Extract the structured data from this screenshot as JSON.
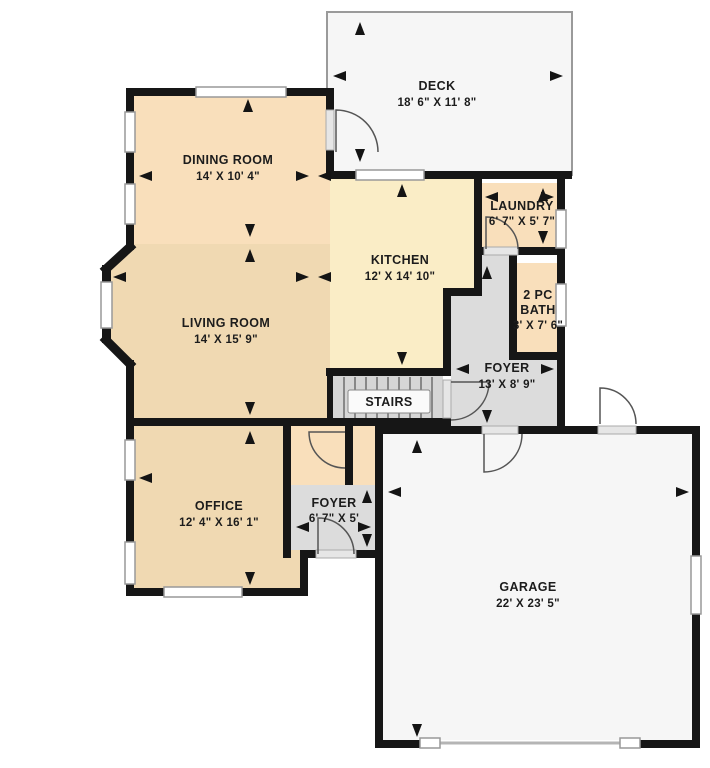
{
  "colors": {
    "wall": "#161616",
    "room_tan": "#f0d9b2",
    "room_peach": "#f9dfbb",
    "room_cream": "#faedc6",
    "room_gray": "#dcdcdc",
    "room_stairs": "#d6d6d6",
    "room_white": "#f6f6f6"
  },
  "rooms": {
    "deck": {
      "name": "DECK",
      "dims": "18' 6\" X 11' 8\""
    },
    "dining": {
      "name": "DINING ROOM",
      "dims": "14' X 10' 4\""
    },
    "kitchen": {
      "name": "KITCHEN",
      "dims": "12' X 14' 10\""
    },
    "laundry": {
      "name": "LAUNDRY",
      "dims": "6' 7\" X 5' 7\""
    },
    "bath": {
      "name_line1": "2 PC",
      "name_line2": "BATH",
      "dims": "3' X 7' 6\""
    },
    "living": {
      "name": "LIVING ROOM",
      "dims": "14' X 15' 9\""
    },
    "foyer_main": {
      "name": "FOYER",
      "dims": "13' X 8' 9\""
    },
    "stairs": {
      "name": "STAIRS"
    },
    "office": {
      "name": "OFFICE",
      "dims": "12' 4\" X 16' 1\""
    },
    "foyer_small": {
      "name": "FOYER",
      "dims": "6' 7\" X 5'"
    },
    "garage": {
      "name": "GARAGE",
      "dims": "22' X 23' 5\""
    }
  }
}
